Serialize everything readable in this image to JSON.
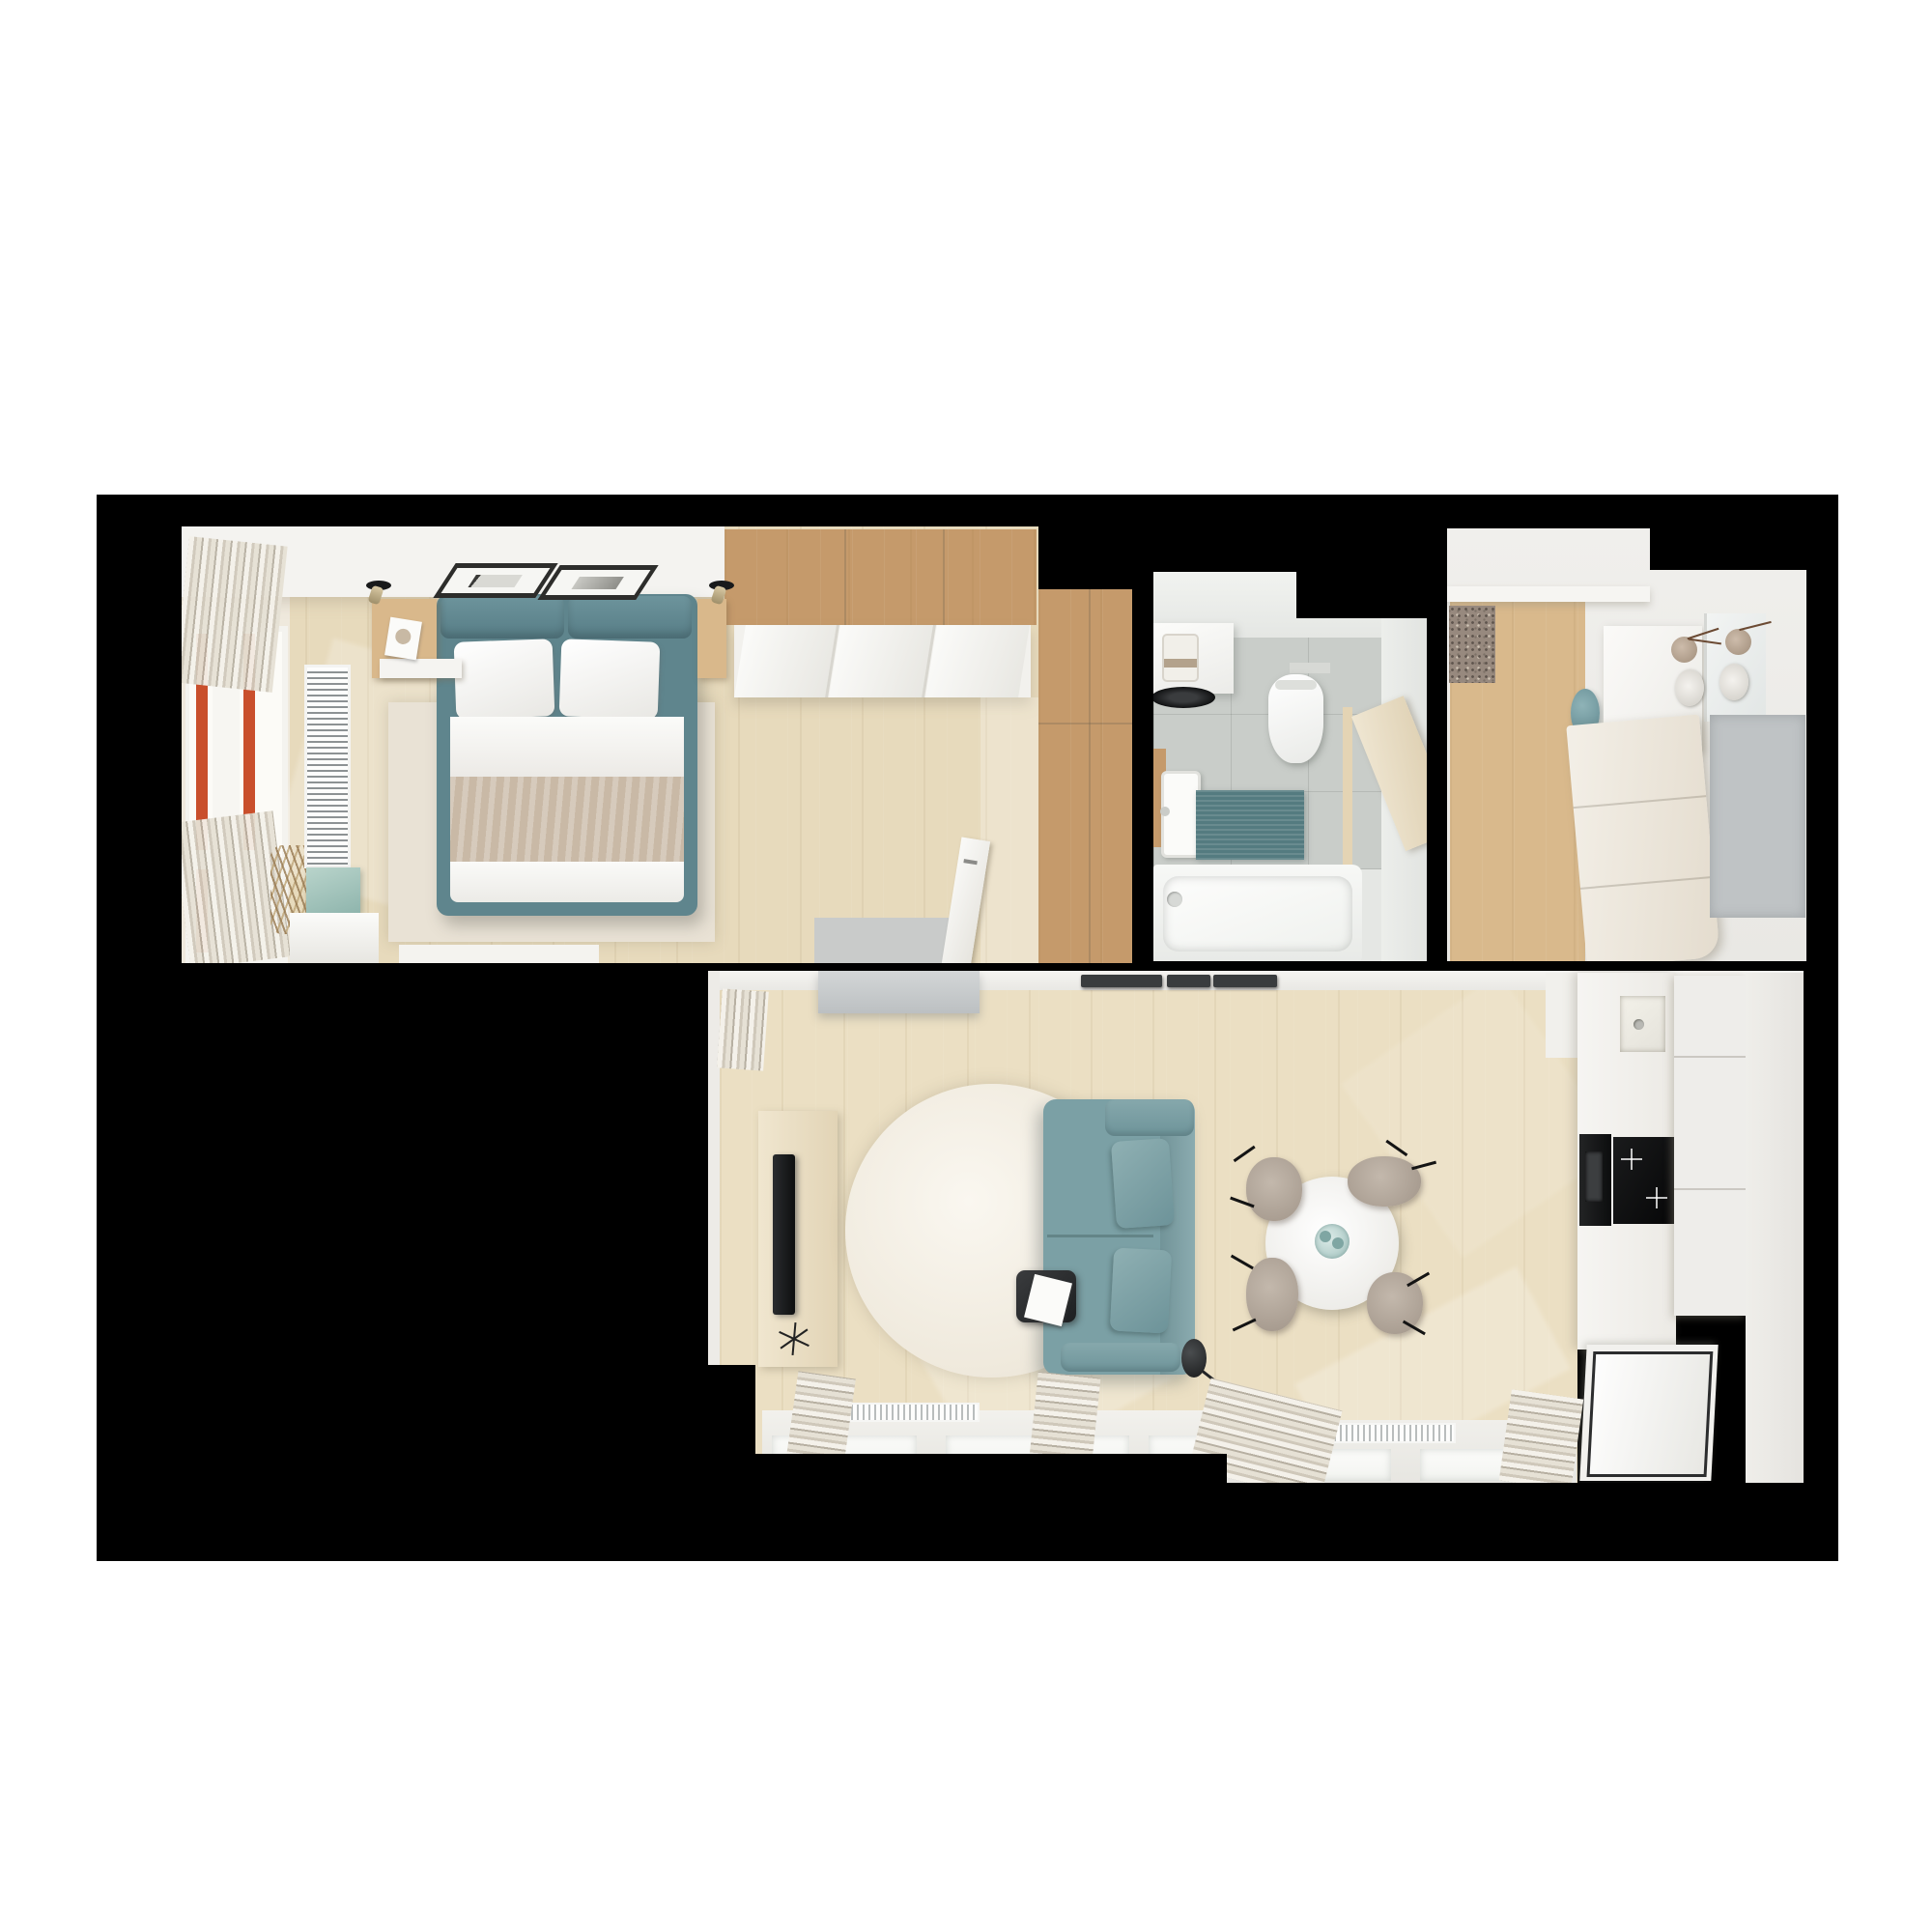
{
  "meta": {
    "type": "3d-architectural-render",
    "view": "top-down floor plan",
    "description": "Photorealistic top-down 3D render of a small apartment on a black background: bedroom (top-left), bathroom (top-center), entrance hall (top-right), and an open living room with dining area and kitchen (bottom)."
  },
  "palette": {
    "page_bg": "#ffffff",
    "canvas_bg": "#000000",
    "wall_white": "#f0efec",
    "ceiling_white": "#f4f3f0",
    "bedroom_floor": "#e7dabc",
    "living_floor": "#ebdfc3",
    "hall_floor": "#d9b98c",
    "oak_wood": "#c59a6b",
    "teal_bed": "#5f858d",
    "teal_sofa": "#7ba0a5",
    "teal_bath_mat": "#547b80",
    "teal_vase": "#6d99a1",
    "mint_bench": "#a5c6bd",
    "blanket_beige": "#c9b9a6",
    "bedroom_rug": "#e9e2d5",
    "round_rug": "#f4f0e7",
    "gray_console": "#c5c8c9",
    "gray_mat": "#bfc3c5",
    "bedroom_gray_mat": "#c9cbca",
    "doormat_speckled": "#97897e",
    "bath_floor_tile": "#c9cdc9",
    "bath_wall": "#e5e7e4",
    "window_red": "#c94f2c",
    "appliance_black": "#101112",
    "mat_dark": "#393c3e",
    "chair_beige": "#b3a79b",
    "table_white": "#f7f6f3",
    "curtain_cream": "#efeae0",
    "door_beige": "#e4d4b4",
    "radiator_white": "#fbfbf9"
  },
  "rooms": {
    "bedroom": {
      "label": "bedroom",
      "furniture": [
        "double bed with teal frame",
        "white pillows",
        "beige blanket",
        "oak overhead wardrobe",
        "white sliding wardrobe",
        "tall oak wardrobe column",
        "window with red frame",
        "white curtains",
        "vertical radiator",
        "linen rug",
        "floating shelf with magazine",
        "mint storage bench",
        "white dresser",
        "two ceiling picture frames",
        "two ceiling spotlights",
        "open white door",
        "gray floor mat"
      ]
    },
    "bathroom": {
      "label": "bathroom",
      "furniture": [
        "countertop with dark vessel sink",
        "small appliance",
        "wall-hung toilet",
        "white washbasin",
        "teal bath mat",
        "bathtub",
        "open beige door",
        "gray tile floor"
      ]
    },
    "hall": {
      "label": "entrance-hall",
      "furniture": [
        "speckled doormat",
        "teal vase",
        "white wardrobe with mirror",
        "two decorative vases with twigs",
        "beige shoe cabinet",
        "gray mat",
        "oak floor"
      ]
    },
    "living_room": {
      "label": "living-room-with-kitchen",
      "furniture": [
        "teal two-seat sofa with cushions",
        "round white shag rug",
        "black side table with papers",
        "black floor lamp",
        "TV board with flat TV on tripod",
        "gray console",
        "three dark doormats",
        "round white dining table with glass centerpiece",
        "four beige chairs with black legs",
        "kitchen counter with sink",
        "built-in black oven",
        "black induction hob",
        "ribbed tall cabinet",
        "glass-front cabinet",
        "two window radiators",
        "four curtain bundles",
        "panorama windows"
      ]
    }
  }
}
